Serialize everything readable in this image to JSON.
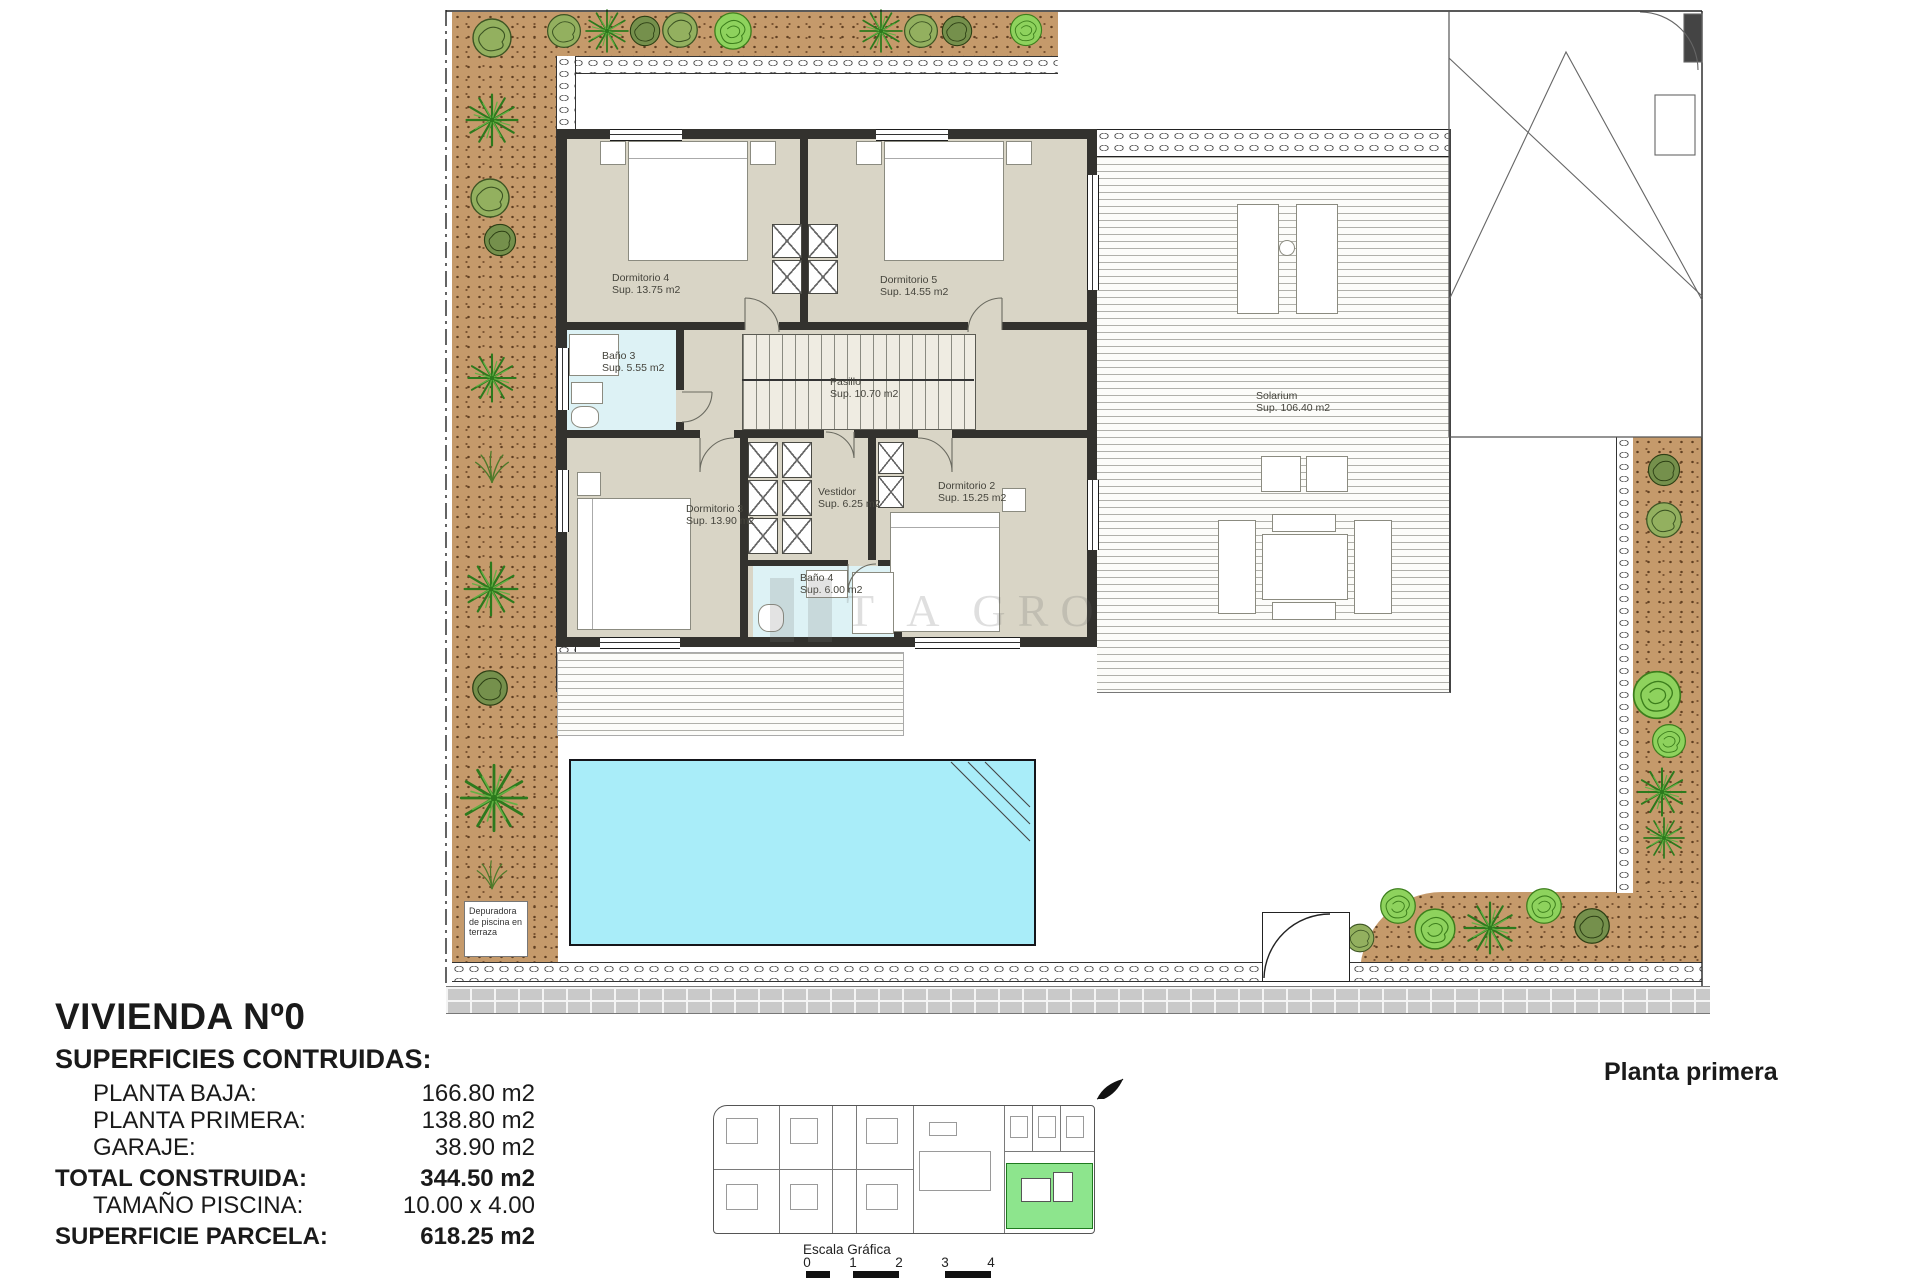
{
  "title": "VIVIENDA Nº0",
  "plan_label": "Planta primera",
  "surfaces": {
    "heading": "SUPERFICIES CONTRUIDAS:",
    "rows": [
      {
        "label": "PLANTA BAJA:",
        "value": "166.80 m2"
      },
      {
        "label": "PLANTA PRIMERA:",
        "value": "138.80 m2"
      },
      {
        "label": "GARAJE:",
        "value": "38.90 m2"
      },
      {
        "label": "TOTAL CONSTRUIDA:",
        "value": "344.50 m2"
      },
      {
        "label": "TAMAÑO PISCINA:",
        "value": "10.00 x 4.00"
      },
      {
        "label": "SUPERFICIE PARCELA:",
        "value": "618.25 m2"
      }
    ]
  },
  "rooms": [
    {
      "name": "Dormitorio 4",
      "area": "Sup. 13.75 m2"
    },
    {
      "name": "Dormitorio 5",
      "area": "Sup. 14.55 m2"
    },
    {
      "name": "Baño 3",
      "area": "Sup. 5.55 m2"
    },
    {
      "name": "Pasillo",
      "area": "Sup. 10.70 m2"
    },
    {
      "name": "Dormitorio 3",
      "area": "Sup. 13.90 m2"
    },
    {
      "name": "Vestidor",
      "area": "Sup. 6.25 m2"
    },
    {
      "name": "Dormitorio 2",
      "area": "Sup. 15.25 m2"
    },
    {
      "name": "Baño 4",
      "area": "Sup. 6.00 m2"
    },
    {
      "name": "Solarium",
      "area": "Sup. 106.40 m2"
    }
  ],
  "annotations": {
    "depuradora": [
      "Depuradora",
      "de piscina",
      "en terraza"
    ],
    "watermark": "T A GRO"
  },
  "scale": {
    "title": "Escala Gráfica",
    "ticks": [
      "0",
      "1",
      "2",
      "3",
      "4"
    ]
  },
  "colors": {
    "pool": "#a9edf9",
    "garden_soil": "#c59a6b",
    "bath_floor": "#ddf2f5",
    "interior_floor": "#d9d5c6",
    "wall": "#33322e",
    "highlight_unit_green": "#8de58d"
  }
}
